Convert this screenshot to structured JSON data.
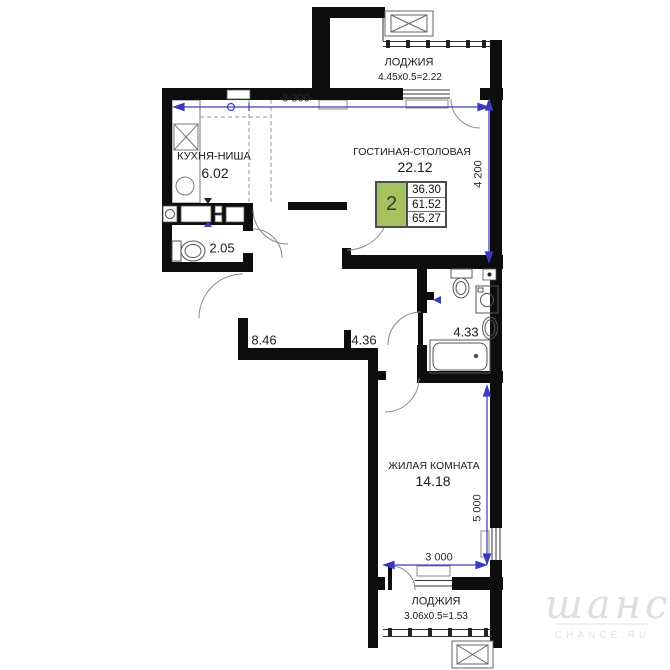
{
  "rooms": {
    "kitchen": {
      "name": "КУХНЯ-НИША",
      "area": "6.02"
    },
    "living_dining": {
      "name": "ГОСТИНАЯ-СТОЛОВАЯ",
      "area": "22.12"
    },
    "wc": {
      "area": "2.05"
    },
    "hall": {
      "area": "8.46"
    },
    "corridor": {
      "area": "4.36"
    },
    "bathroom": {
      "area": "4.33"
    },
    "bedroom": {
      "name": "ЖИЛАЯ КОМНАТА",
      "area": "14.18"
    },
    "loggia_top": {
      "name": "ЛОДЖИЯ",
      "calc": "4.45x0.5=2.22"
    },
    "loggia_bottom": {
      "name": "ЛОДЖИЯ",
      "calc": "3.06x0.5=1.53"
    }
  },
  "dimensions": {
    "top_width": "8 300",
    "right_height": "4 200",
    "bedroom_height": "5 000",
    "bedroom_width": "3 000"
  },
  "summary": {
    "rooms_count": "2",
    "living_area": "36.30",
    "area_without_loggia": "61.52",
    "total_area": "65.27",
    "accent_green": "#a5c45f"
  },
  "watermark": {
    "script": "шанс",
    "site": "CHANCE.RU"
  },
  "colors": {
    "walls": "#0d0d0d",
    "dimension_blue": "#3a3ac0"
  }
}
